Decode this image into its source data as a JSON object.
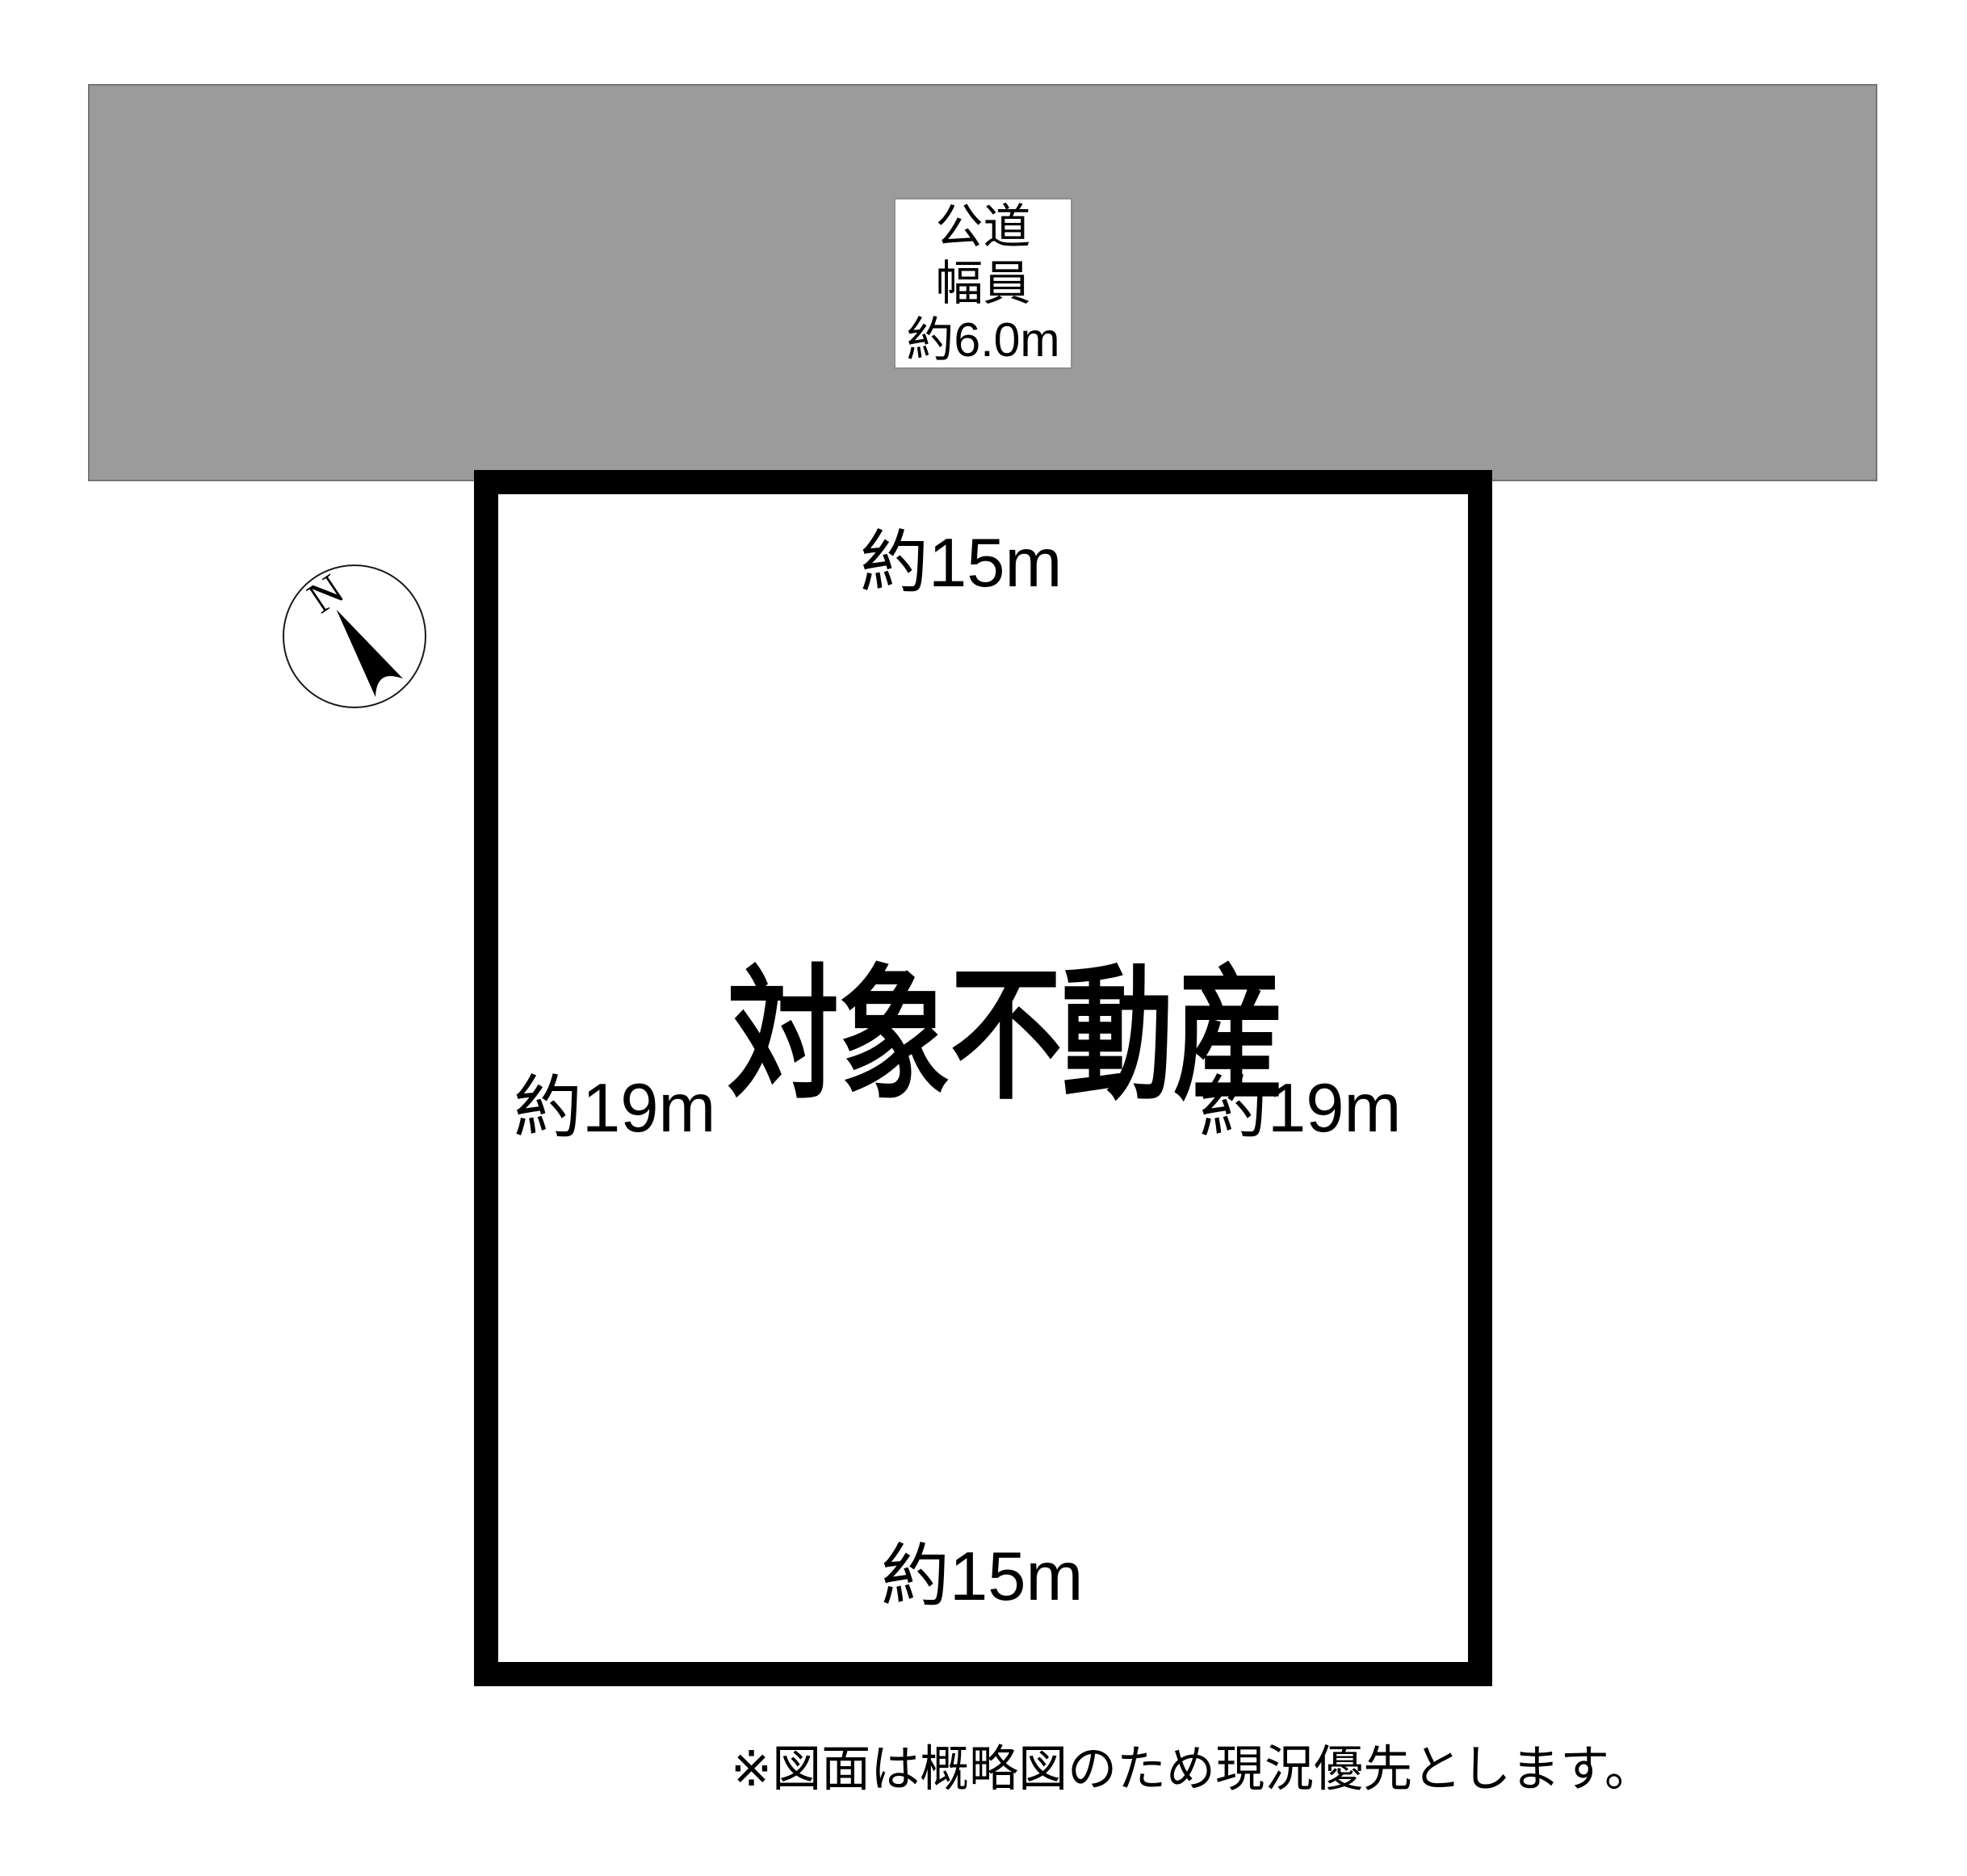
{
  "road": {
    "fill_color": "#9b9b9b",
    "border_color": "#757575",
    "label_lines": [
      "公道",
      "幅員",
      "約6.0m"
    ]
  },
  "parcel": {
    "title": "対象不動産",
    "outline_color": "#000000",
    "dim_top": "約15m",
    "dim_bottom": "約15m",
    "dim_left": "約19m",
    "dim_right": "約19m"
  },
  "compass": {
    "label": "N"
  },
  "note": {
    "text": "※図面は概略図のため現況優先とします。"
  }
}
